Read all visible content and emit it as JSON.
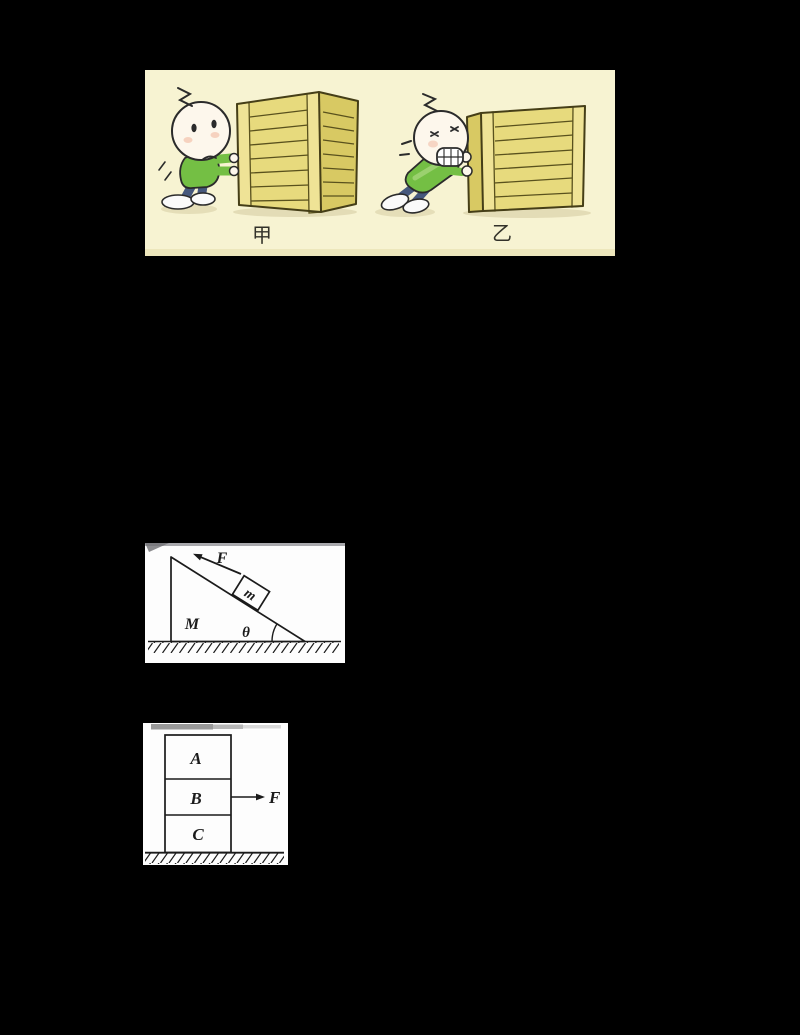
{
  "page": {
    "background": "#000000"
  },
  "cartoon_figure": {
    "bg": "#f7f3d2",
    "scene_left_label": "甲",
    "scene_right_label": "乙",
    "colors": {
      "crate_front": "#e7da7d",
      "crate_side": "#d8c963",
      "crate_post": "#efe396",
      "crate_line": "#59511d",
      "crate_outline": "#453e17",
      "shirt": "#74bf44",
      "shirt_highlight": "#a8d77e",
      "pants": "#46587d",
      "skin": "#fdf7ec",
      "outline": "#2b2b2b",
      "cheek": "#f0b49b",
      "shadow": "#cfc69a",
      "label_color": "#33322a"
    }
  },
  "incline_figure": {
    "bg": "#fdfdfd",
    "line_color": "#1b1b1b",
    "force_label": "F",
    "block_label": "m",
    "wedge_label": "M",
    "angle_label": "θ"
  },
  "stack_figure": {
    "bg": "#fdfdfd",
    "line_color": "#1b1b1b",
    "block_a": "A",
    "block_b": "B",
    "block_c": "C",
    "force_label": "F"
  }
}
